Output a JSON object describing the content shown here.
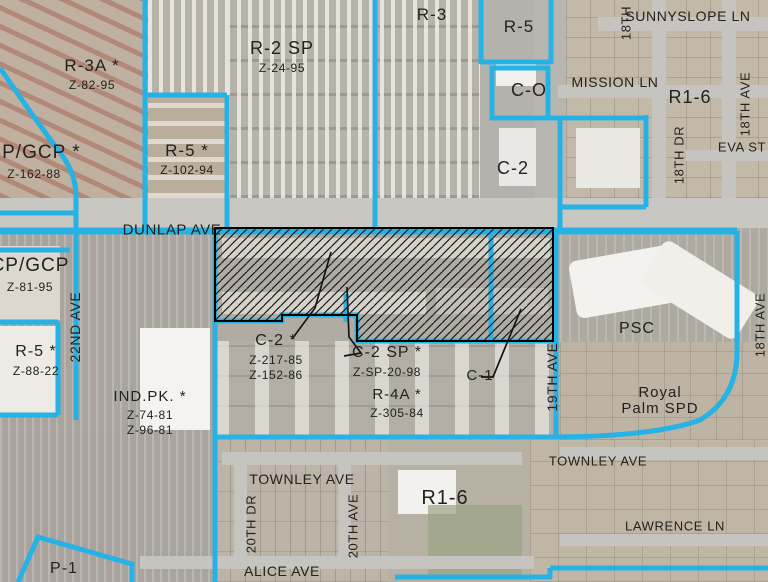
{
  "map": {
    "type": "zoning-map-over-aerial",
    "boundary_color": "#27b2e6",
    "hatch": {
      "style": "diagonal-lines",
      "line_color": "#1c1c1c",
      "outline_color": "#000000",
      "meaning": "cross-hatched subject parcels along Dunlap Ave (C-2 / C-2 SP / C-1)"
    },
    "leader_line_color": "#151515",
    "label_color": "#23221e",
    "zones": [
      {
        "name": "R-3A *",
        "cases": [
          "Z-82-95"
        ],
        "x": 92,
        "y": 69,
        "fs": 17
      },
      {
        "name": "CP/GCP *",
        "cases": [
          "Z-162-88"
        ],
        "x": 34,
        "y": 157,
        "fs": 19
      },
      {
        "name": "R-5 *",
        "cases": [
          "Z-102-94"
        ],
        "x": 187,
        "y": 154,
        "fs": 17
      },
      {
        "name": "R-2 SP",
        "cases": [
          "Z-24-95"
        ],
        "x": 282,
        "y": 52,
        "fs": 18
      },
      {
        "name": "R-3",
        "cases": [],
        "x": 432,
        "y": 18,
        "fs": 17
      },
      {
        "name": "R-5",
        "cases": [],
        "x": 519,
        "y": 30,
        "fs": 17
      },
      {
        "name": "C-O",
        "cases": [],
        "x": 529,
        "y": 94,
        "fs": 18
      },
      {
        "name": "C-2",
        "cases": [],
        "x": 513,
        "y": 172,
        "fs": 18
      },
      {
        "name": "R1-6",
        "cases": [],
        "x": 690,
        "y": 101,
        "fs": 18
      },
      {
        "name": "CP/GCP",
        "cases": [
          "Z-81-95"
        ],
        "x": 30,
        "y": 270,
        "fs": 19
      },
      {
        "name": "R-5 *",
        "cases": [
          "Z-88-22"
        ],
        "x": 36,
        "y": 355,
        "fs": 16
      },
      {
        "name": "IND.PK. *",
        "cases": [
          "Z-74-81",
          "Z-96-81"
        ],
        "x": 150,
        "y": 400,
        "fs": 15
      },
      {
        "name": "C-2 *",
        "cases": [
          "Z-217-85",
          "Z-152-86"
        ],
        "x": 276,
        "y": 344,
        "fs": 16
      },
      {
        "name": "C-2 SP *",
        "cases": [
          "Z-SP-20-98"
        ],
        "x": 387,
        "y": 356,
        "fs": 16
      },
      {
        "name": "R-4A *",
        "cases": [
          "Z-305-84"
        ],
        "x": 397,
        "y": 398,
        "fs": 15
      },
      {
        "name": "C-1",
        "cases": [],
        "x": 480,
        "y": 379,
        "fs": 15
      },
      {
        "name": "PSC",
        "cases": [],
        "x": 637,
        "y": 332,
        "fs": 16
      },
      {
        "name": "Royal",
        "sub": [
          "Palm SPD"
        ],
        "cases": [],
        "x": 660,
        "y": 396,
        "fs": 15
      },
      {
        "name": "R1-6",
        "cases": [],
        "x": 445,
        "y": 502,
        "fs": 20
      },
      {
        "name": "P-1",
        "cases": [],
        "x": 64,
        "y": 572,
        "fs": 16
      }
    ],
    "streets": [
      {
        "name": "SUNNYSLOPE LN",
        "x": 688,
        "y": 16,
        "v": false,
        "fs": 14
      },
      {
        "name": "18TH",
        "x": 626,
        "y": 23,
        "v": true,
        "fs": 13
      },
      {
        "name": "MISSION LN",
        "x": 615,
        "y": 82,
        "v": false,
        "fs": 14
      },
      {
        "name": "18TH AVE",
        "x": 745,
        "y": 104,
        "v": true,
        "fs": 13
      },
      {
        "name": "18TH DR",
        "x": 679,
        "y": 155,
        "v": true,
        "fs": 13
      },
      {
        "name": "EVA ST",
        "x": 742,
        "y": 147,
        "v": false,
        "fs": 13
      },
      {
        "name": "DUNLAP AVE",
        "x": 172,
        "y": 230,
        "v": false,
        "fs": 15
      },
      {
        "name": "22ND AVE",
        "x": 75,
        "y": 327,
        "v": true,
        "fs": 14
      },
      {
        "name": "19TH AVE",
        "x": 552,
        "y": 377,
        "v": true,
        "fs": 14
      },
      {
        "name": "18TH AVE",
        "x": 760,
        "y": 325,
        "v": true,
        "fs": 13
      },
      {
        "name": "TOWNLEY AVE",
        "x": 302,
        "y": 479,
        "v": false,
        "fs": 14
      },
      {
        "name": "TOWNLEY AVE",
        "x": 598,
        "y": 461,
        "v": false,
        "fs": 13
      },
      {
        "name": "LAWRENCE LN",
        "x": 675,
        "y": 526,
        "v": false,
        "fs": 13
      },
      {
        "name": "20TH DR",
        "x": 251,
        "y": 524,
        "v": true,
        "fs": 13
      },
      {
        "name": "20TH AVE",
        "x": 353,
        "y": 526,
        "v": true,
        "fs": 13
      },
      {
        "name": "ALICE AVE",
        "x": 282,
        "y": 571,
        "v": false,
        "fs": 14
      }
    ]
  }
}
